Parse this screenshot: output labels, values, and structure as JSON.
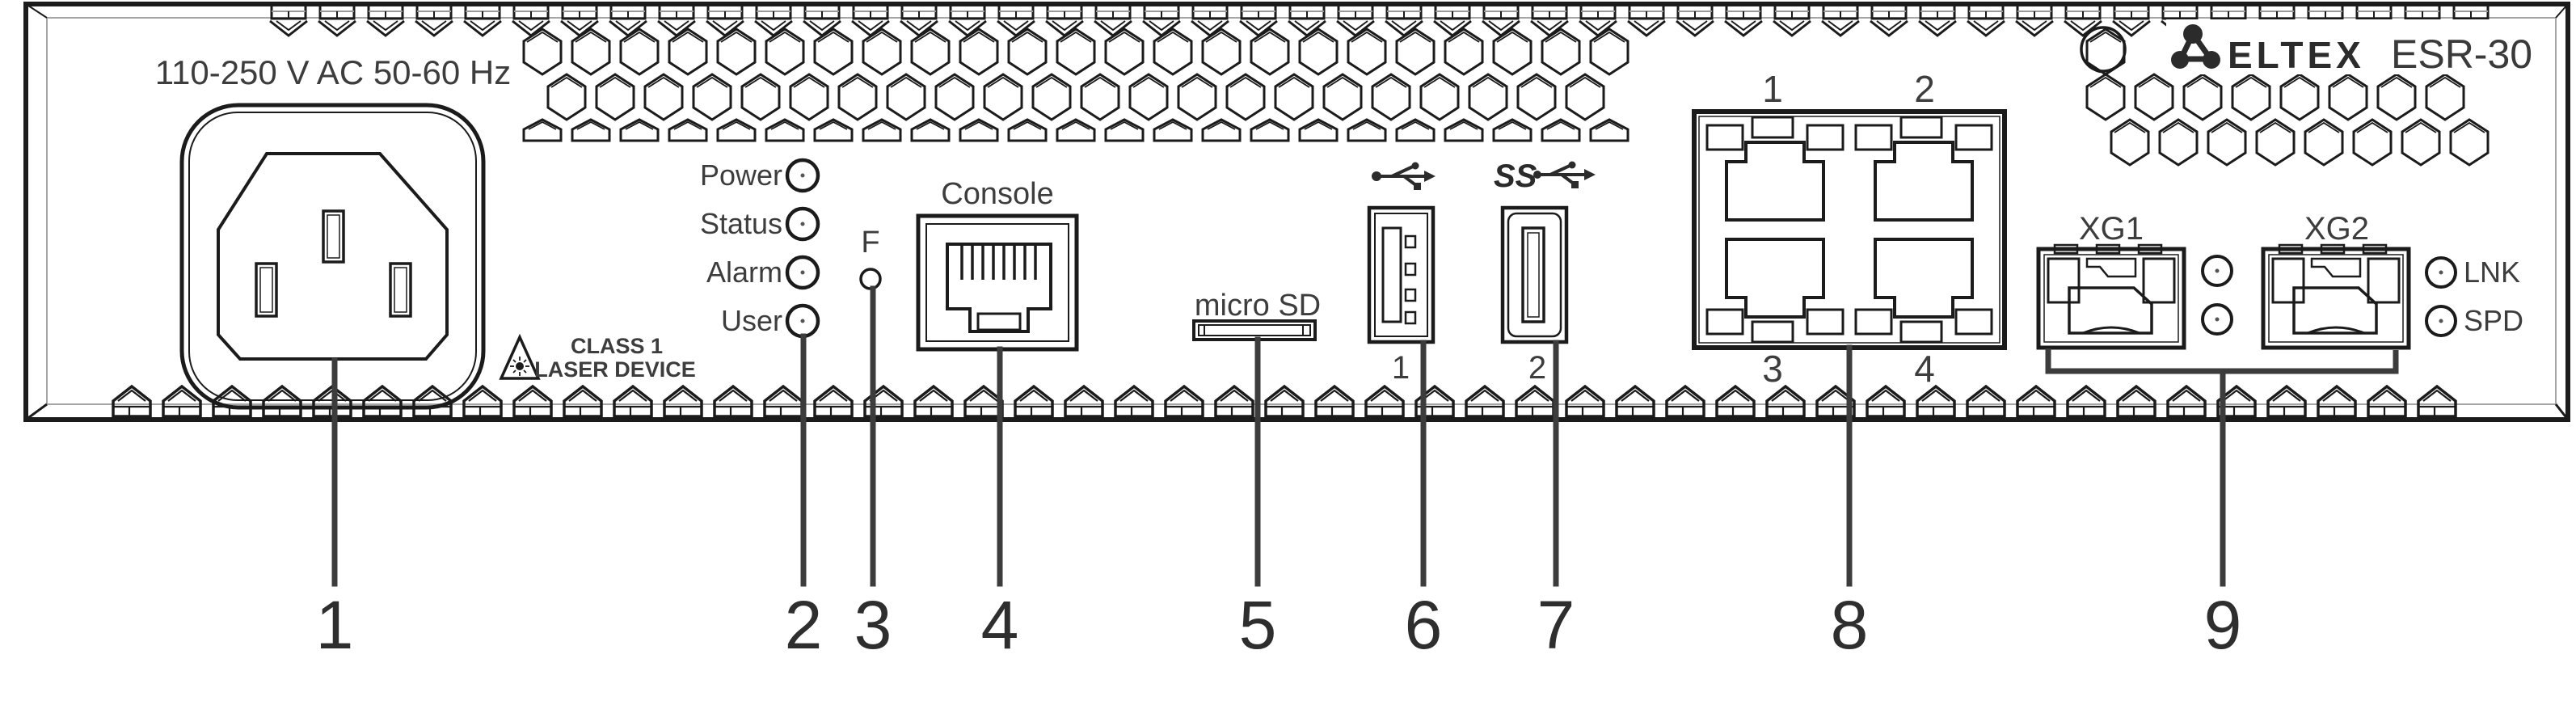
{
  "device": {
    "brand": "ELTEX",
    "model": "ESR-30"
  },
  "front_panel": {
    "power_rating": "110-250 V AC 50-60 Hz",
    "laser_warning": {
      "line1": "CLASS 1",
      "line2": "LASER DEVICE"
    },
    "leds": [
      {
        "label": "Power"
      },
      {
        "label": "Status"
      },
      {
        "label": "Alarm"
      },
      {
        "label": "User"
      }
    ],
    "function_button": {
      "label": "F"
    },
    "console_port": {
      "label": "Console"
    },
    "microsd_slot": {
      "label": "micro SD"
    },
    "usb_ports": [
      {
        "label": "1",
        "icon": "usb-2.0-icon",
        "ss_prefix": ""
      },
      {
        "label": "2",
        "icon": "usb-3.0-ss-icon",
        "ss_prefix": "SS"
      }
    ],
    "ethernet_ports": {
      "top_labels": [
        "1",
        "2"
      ],
      "bottom_labels": [
        "3",
        "4"
      ]
    },
    "sfp_ports": [
      {
        "label": "XG1"
      },
      {
        "label": "XG2"
      }
    ],
    "sfp_leds": [
      {
        "label": "LNK"
      },
      {
        "label": "SPD"
      }
    ]
  },
  "callouts": {
    "labels": [
      "1",
      "2",
      "3",
      "4",
      "5",
      "6",
      "7",
      "8",
      "9"
    ]
  },
  "colors": {
    "line": "#1b1b1b",
    "text": "#3d3d3d",
    "leader": "#3c3c3c",
    "accent_gray": "#a5a5a5"
  }
}
